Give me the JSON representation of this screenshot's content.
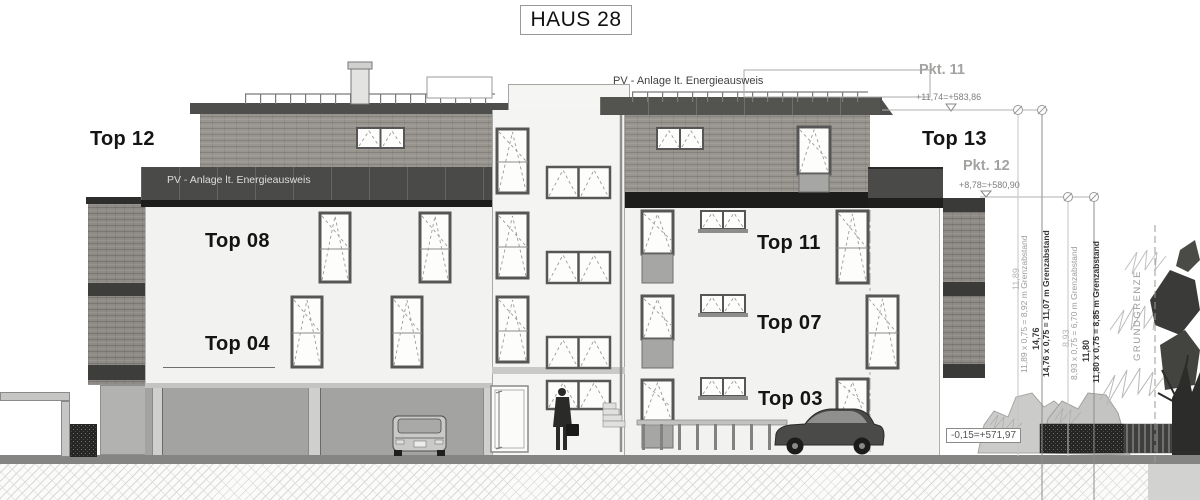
{
  "title": "HAUS 28",
  "roof": {
    "pv_label": "PV - Anlage lt. Energieausweis"
  },
  "pv_band": {
    "label": "PV - Anlage lt. Energieausweis"
  },
  "apartments": {
    "top12": "Top 12",
    "top13": "Top 13",
    "top08": "Top 08",
    "top11": "Top 11",
    "top04": "Top 04",
    "top07": "Top 07",
    "top03": "Top 03"
  },
  "levels": {
    "pkt11_name": "Pkt. 11",
    "pkt11_value": "+11,74=+583,86",
    "pkt12_name": "Pkt. 12",
    "pkt12_value": "+8,78=+580,90",
    "ground_value": "-0,15=+571,97"
  },
  "dimensions": {
    "d1_value": "11,89",
    "d1_text": "11,89 x 0,75 = 8,92 m Grenzabstand",
    "d2_value": "14,76",
    "d2_text": "14,76 x 0,75 = 11,07 m Grenzabstand",
    "d3_value": "8,93",
    "d3_text": "8,93 x 0,75 = 6,70 m Grenzabstand",
    "d4_value": "11,80",
    "d4_text": "11,80 x 0,75 = 8,85 m Grenzabstand"
  },
  "site": {
    "boundary_label": "GRUNDGRENZE"
  },
  "colors": {
    "band_dark": "#4a4a48",
    "brick": "#98948e",
    "facade": "#f2f2f1",
    "accent_text": "#141414"
  }
}
